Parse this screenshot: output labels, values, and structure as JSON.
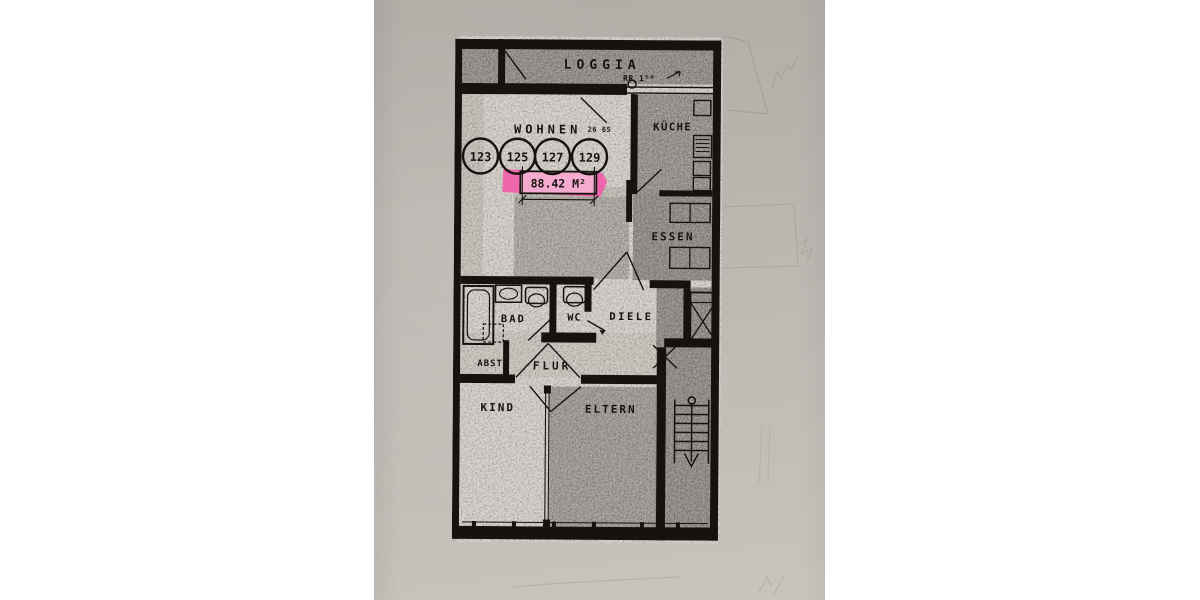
{
  "photo": {
    "description_colors": {
      "paper": "#bcb8b2",
      "plan_paper": "#d9d5cf",
      "ink": "#16130e",
      "highlight_pink": "#f25ca8"
    }
  },
  "floorplan": {
    "rooms": {
      "loggia": "LOGGIA",
      "wohnen": "WOHNEN",
      "kueche": "KÜCHE",
      "essen": "ESSEN",
      "bad": "BAD",
      "wc": "WC",
      "diele": "DIELE",
      "abst": "ABST",
      "flur": "FLUR",
      "kind": "KIND",
      "eltern": "ELTERN"
    },
    "unit_numbers": [
      "123",
      "125",
      "127",
      "129"
    ],
    "annotations": {
      "area": "88.42 M²",
      "dimension": "26 65",
      "rain_pipe": "RR 1⁵⁰"
    }
  }
}
